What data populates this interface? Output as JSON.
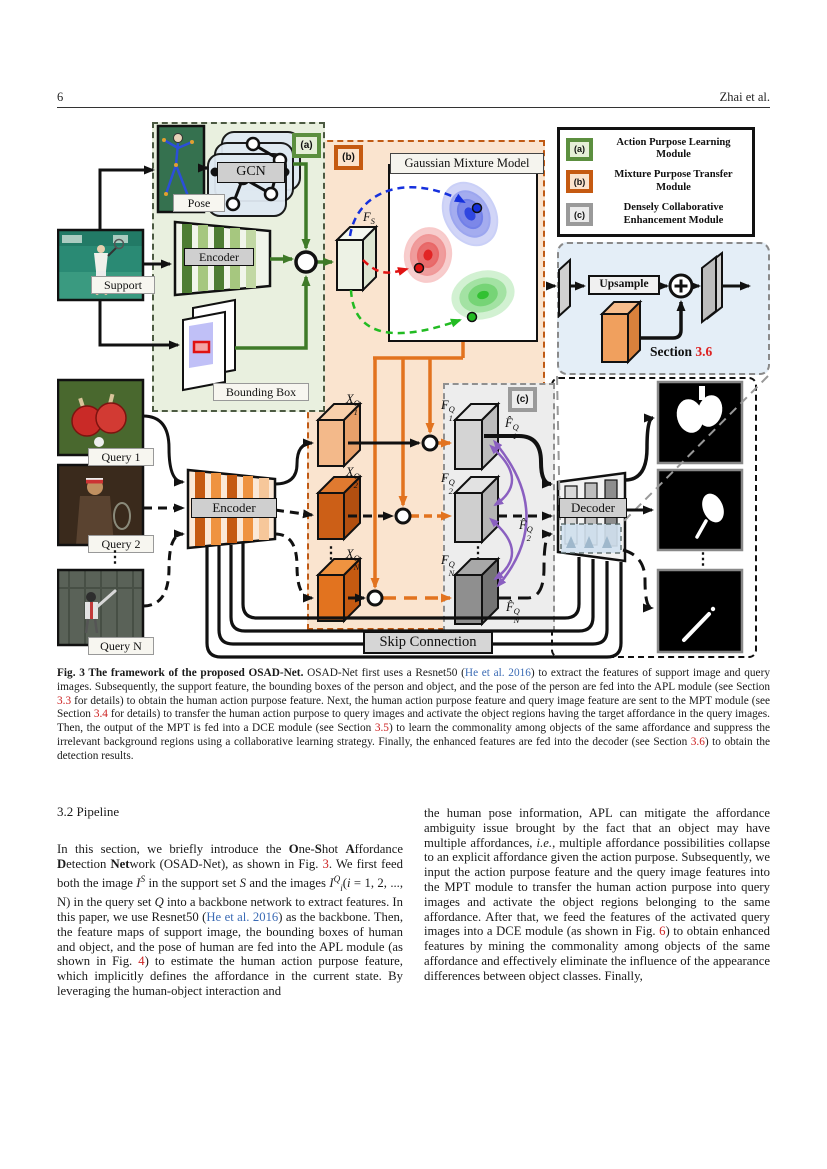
{
  "page": {
    "number": "6",
    "running_head": "Zhai et al."
  },
  "figure": {
    "badges": {
      "a": "(a)",
      "b": "(b)",
      "c": "(c)"
    },
    "labels": {
      "pose": "Pose",
      "gcn": "GCN",
      "support": "Support",
      "encoder": "Encoder",
      "decoder": "Decoder",
      "bounding_box": "Bounding Box",
      "gmm_title": "Gaussian Mixture Model",
      "query1": "Query 1",
      "query2": "Query 2",
      "queryn": "Query N",
      "skip": "Skip Connection",
      "upsample": "Upsample",
      "section_prefix": "Section",
      "section_number": "3.6",
      "dots": "⋮"
    },
    "features": {
      "fs": {
        "base": "F",
        "sup": "S",
        "sub": ""
      },
      "x1": {
        "base": "X",
        "sup": "Q",
        "sub": "1"
      },
      "x2": {
        "base": "X",
        "sup": "Q",
        "sub": "2"
      },
      "xn": {
        "base": "X",
        "sup": "Q",
        "sub": "N"
      },
      "f1": {
        "base": "F",
        "sup": "Q",
        "sub": "1"
      },
      "f2": {
        "base": "F",
        "sup": "Q",
        "sub": "2"
      },
      "fn": {
        "base": "F",
        "sup": "Q",
        "sub": "N"
      },
      "f1hat": {
        "base": "F̂",
        "sup": "Q",
        "sub": "1"
      },
      "f2hat": {
        "base": "F̂",
        "sup": "Q",
        "sub": "2"
      },
      "fnhat": {
        "base": "F̂",
        "sup": "Q",
        "sub": "N"
      }
    },
    "legend": {
      "items": [
        {
          "badge": "(a)",
          "label": "Action Purpose Learning Module",
          "color": "#5c8f3f"
        },
        {
          "badge": "(b)",
          "label": "Mixture Purpose Transfer Module",
          "color": "#c55a11"
        },
        {
          "badge": "(c)",
          "label": "Densely Collaborative Enhancement Module",
          "color": "#9a9a9a"
        }
      ]
    },
    "colors": {
      "apl_green": "#5c8f3f",
      "mpt_orange": "#c55a11",
      "dce_gray": "#9a9a9a",
      "ref_red": "#cc2222",
      "link_blue": "#3b6bb5",
      "purple_arrow": "#8a5fc0"
    }
  },
  "caption": {
    "segments": [
      {
        "t": "Fig. 3  The framework of the proposed OSAD-Net.",
        "s": "bold"
      },
      {
        "t": " OSAD-Net first uses a Resnet50 ("
      },
      {
        "t": "He et al. 2016",
        "s": "link"
      },
      {
        "t": ") to extract the features of support image and query images. Subsequently, the support feature, the bounding boxes of the person and object, and the pose of the person are fed into the APL module (see Section "
      },
      {
        "t": "3.3",
        "s": "ref"
      },
      {
        "t": " for details) to obtain the human action purpose feature. Next, the human action purpose feature and query image feature are sent to the MPT module (see Section "
      },
      {
        "t": "3.4",
        "s": "ref"
      },
      {
        "t": " for details) to transfer the human action purpose to query images and activate the object regions having the target affordance in the query images. Then, the output of the MPT is fed into a DCE module (see Section "
      },
      {
        "t": "3.5",
        "s": "ref"
      },
      {
        "t": ") to learn the commonality among objects of the same affordance and suppress the irrelevant background regions using a collaborative learning strategy. Finally, the enhanced features are fed into the decoder (see Section "
      },
      {
        "t": "3.6",
        "s": "ref"
      },
      {
        "t": ") to obtain the detection results."
      }
    ]
  },
  "body": {
    "heading": "3.2 Pipeline",
    "left_segments": [
      {
        "t": "In this section, we briefly introduce the "
      },
      {
        "t": "O",
        "s": "bold"
      },
      {
        "t": "ne-"
      },
      {
        "t": "S",
        "s": "bold"
      },
      {
        "t": "hot "
      },
      {
        "t": "A",
        "s": "bold"
      },
      {
        "t": "ffordance "
      },
      {
        "t": "D",
        "s": "bold"
      },
      {
        "t": "etection "
      },
      {
        "t": "Net",
        "s": "bold"
      },
      {
        "t": "work (OSAD-Net), as shown in Fig. "
      },
      {
        "t": "3",
        "s": "ref"
      },
      {
        "t": ". We first feed both the image "
      },
      {
        "t": "I",
        "s": "italic"
      },
      {
        "t": "S",
        "s": "sup"
      },
      {
        "t": " in the support set "
      },
      {
        "t": "S",
        "s": "italic"
      },
      {
        "t": " and the images "
      },
      {
        "t": "I",
        "s": "italic"
      },
      {
        "t": "Q",
        "s": "sup"
      },
      {
        "t": "i",
        "s": "sub"
      },
      {
        "t": "("
      },
      {
        "t": "i",
        "s": "italic"
      },
      {
        "t": " = 1, 2, ..., N) in the query set "
      },
      {
        "t": "Q",
        "s": "italic"
      },
      {
        "t": " into a backbone network to extract features. In this paper, we use Resnet50 ("
      },
      {
        "t": "He et al. 2016",
        "s": "link"
      },
      {
        "t": ") as the backbone. Then, the feature maps of support image, the bounding boxes of human and object, and the pose of human are fed into the APL module (as shown in Fig. "
      },
      {
        "t": "4",
        "s": "ref"
      },
      {
        "t": ") to estimate the human action purpose feature, which implicitly defines the affordance in the current state. By leveraging the human-object interaction and"
      }
    ],
    "right_segments": [
      {
        "t": "the human pose information, APL can mitigate the affordance ambiguity issue brought by the fact that an object may have multiple affordances, "
      },
      {
        "t": "i.e.",
        "s": "italic"
      },
      {
        "t": ", multiple affordance possibilities collapse to an explicit affordance given the action purpose. Subsequently, we input the action purpose feature and the query image features into the MPT module to transfer the human action purpose into query images and activate the object regions belonging to the same affordance. After that, we feed the features of the activated query images into a DCE module (as shown in Fig. "
      },
      {
        "t": "6",
        "s": "ref"
      },
      {
        "t": ") to obtain enhanced features by mining the commonality among objects of the same affordance and effectively eliminate the influence of the appearance differences between object classes. Finally,"
      }
    ]
  }
}
